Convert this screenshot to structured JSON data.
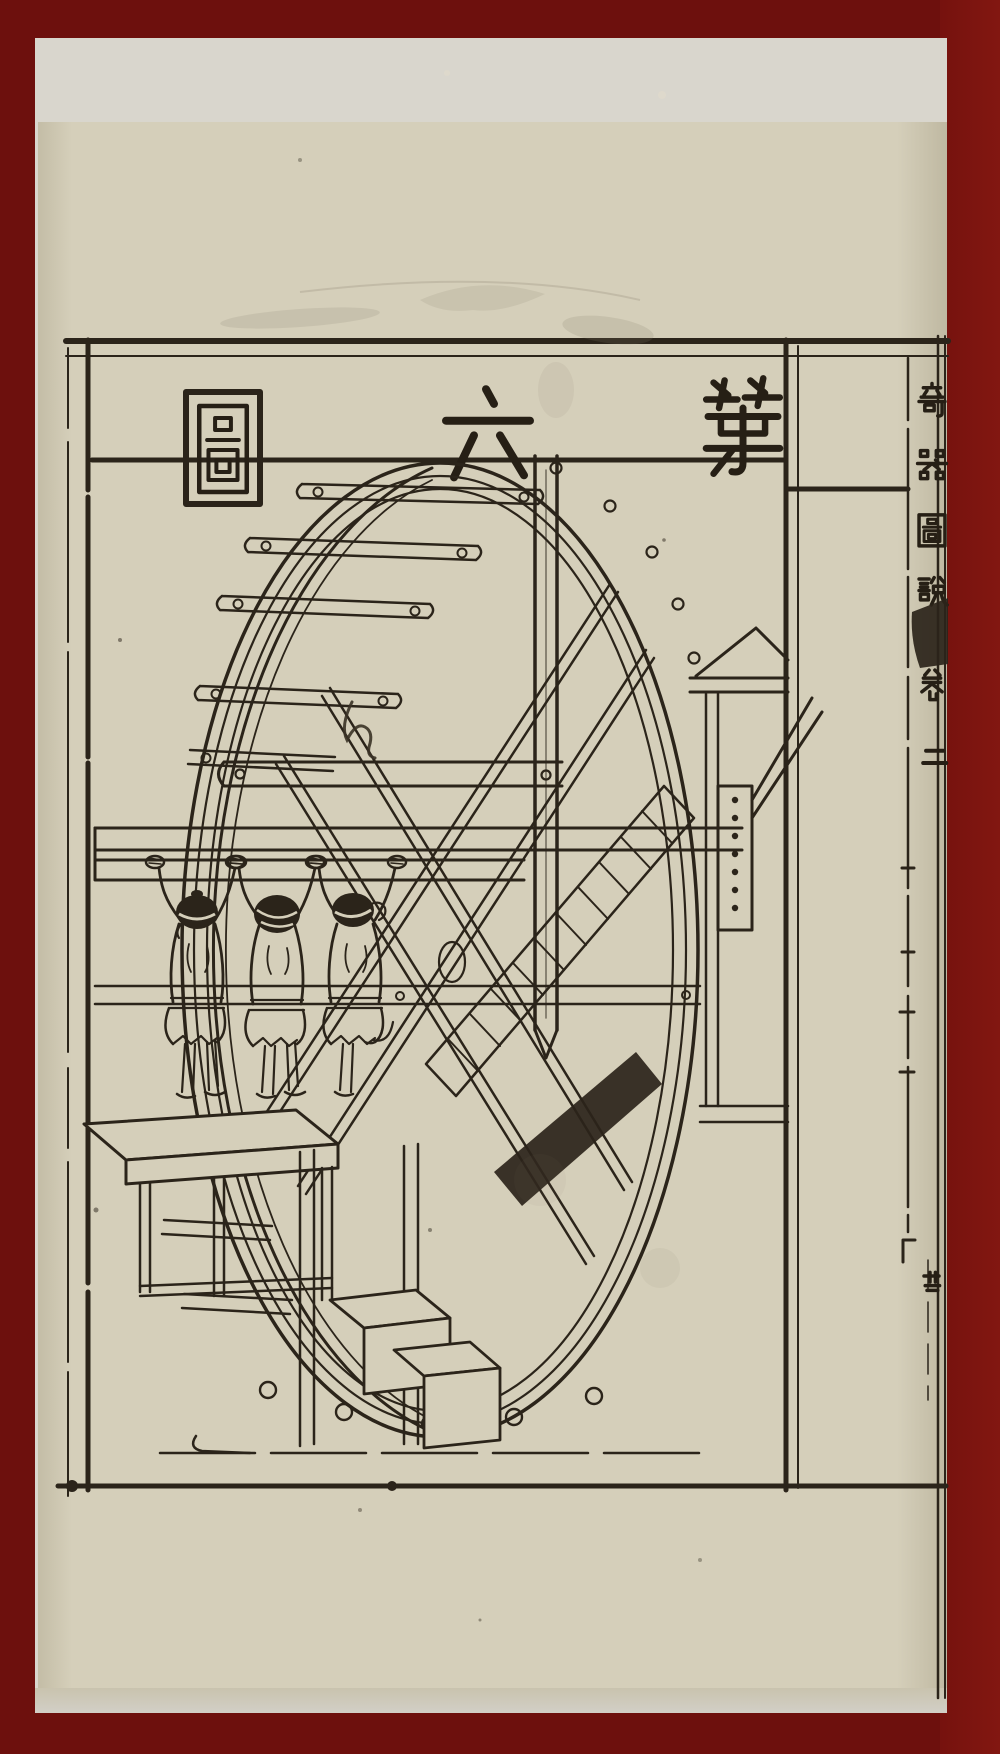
{
  "title_plate": {
    "chars_rtl": [
      "第",
      "六",
      "圖"
    ],
    "boxed_char": "圖"
  },
  "margin_column": {
    "book_title_chars": [
      "竒",
      "器",
      "圖",
      "說"
    ],
    "volume_label_chars": [
      "卷",
      "二"
    ],
    "fold_edge_char": "卋"
  },
  "annotations": {
    "handwritten_mark": "ん"
  },
  "colors": {
    "mat_red": "#6d100d",
    "backing_paper": "#d9d6cd",
    "page_paper": "#d5cfba",
    "ink": "#2b241a"
  }
}
